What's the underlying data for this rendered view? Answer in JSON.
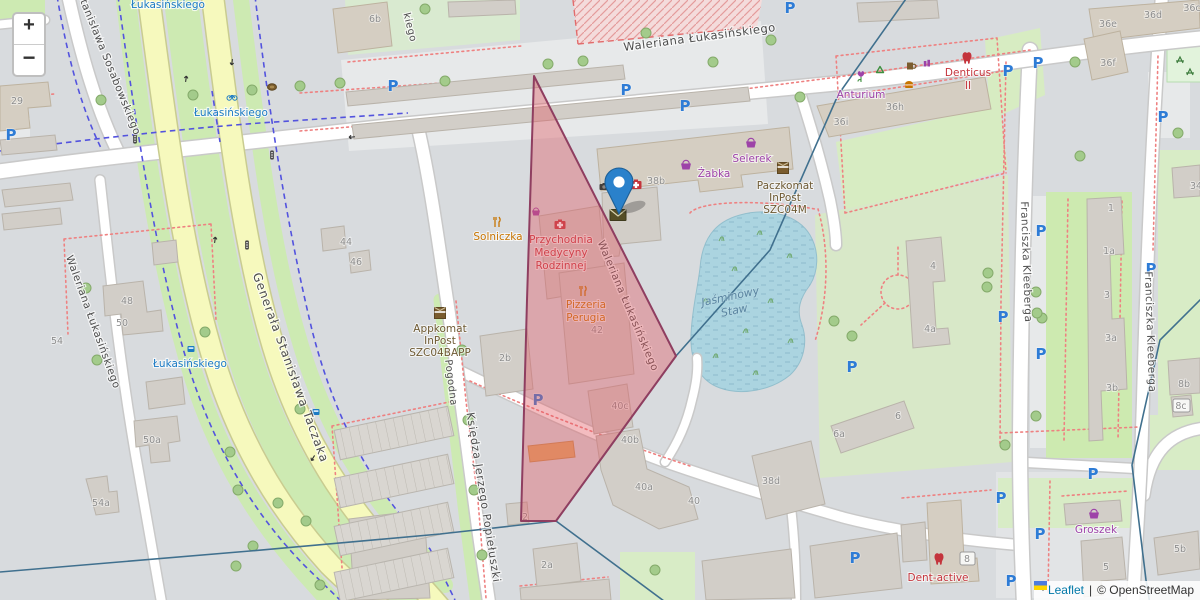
{
  "controls": {
    "zoom_in": "+",
    "zoom_out": "−"
  },
  "attribution": {
    "leaflet": "Leaflet",
    "separator": "|",
    "osm": "© OpenStreetMap"
  },
  "icons": {
    "parking": "P"
  },
  "colors": {
    "selection_fill": "#e25862",
    "selection_border": "#8f3e60",
    "water": "#abd4e0",
    "marker_blue": "#2a81cb",
    "parking_blue": "#2e7cd6",
    "shop_purple": "#9d43a8",
    "health_red": "#c4343c",
    "gastronomy_orange": "#c77400",
    "inpost_brown": "#6e5a33",
    "bus_blue": "#1b7ac4",
    "road_yellow": "#f6f9bd",
    "grass_green": "#cdeab2"
  },
  "streets": [
    "Waleriana Łukasińskiego",
    "Stanisława Sosabowskiego",
    "Generała Stanisława Taczaka",
    "Waleriana Łukasińskiego",
    "Waleriana Łukasińskiego",
    "Księdza Jerzego Popiełuszki",
    "Franciszka Kleeberga",
    "Franciszka Kleeberga",
    "Pogodna",
    "kiego"
  ],
  "bus_stops": [
    "Łukasińskiego",
    "Łukasińskiego",
    "Łukasińskiego"
  ],
  "pois": {
    "solniczka": [
      "Solniczka"
    ],
    "przychodnia": [
      "Przychodnia",
      "Medycyny",
      "Rodzinnej"
    ],
    "pizzeria": [
      "Pizzeria",
      "Perugia"
    ],
    "zabka": [
      "Żabka"
    ],
    "selerek": [
      "Selerek"
    ],
    "paczkomat": [
      "Paczkomat",
      "InPost",
      "SZC04M"
    ],
    "appkomat": [
      "Appkomat",
      "InPost",
      "SZC04BAPP"
    ],
    "anturium": [
      "Anturium"
    ],
    "denticus": [
      "Denticus",
      "II"
    ],
    "dent_active": [
      "Dent-active"
    ],
    "groszek": [
      "Groszek"
    ]
  },
  "water_label": [
    "Jaśminowy",
    "Staw"
  ],
  "house_numbers": [
    "29",
    "6b",
    "48",
    "50",
    "54",
    "50a",
    "54a",
    "44",
    "46",
    "2b",
    "38b",
    "42",
    "36i",
    "36h",
    "36e",
    "36d",
    "36c",
    "36f",
    "34",
    "1",
    "1a",
    "3",
    "3a",
    "3b",
    "8b",
    "8c",
    "4",
    "4a",
    "6",
    "6a",
    "40c",
    "40b",
    "40a",
    "40",
    "38d",
    "2a",
    "2",
    "5",
    "5b",
    "8"
  ]
}
